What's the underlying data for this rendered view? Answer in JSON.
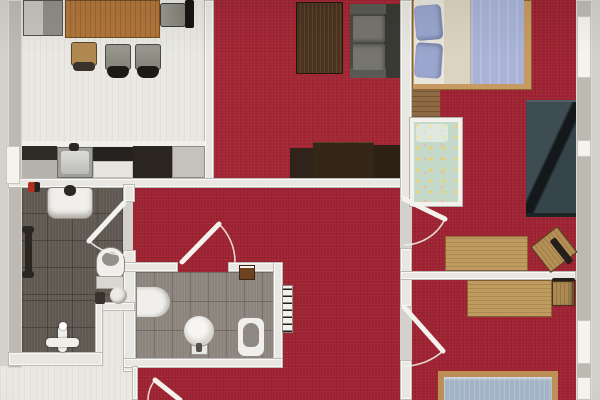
{
  "meta": {
    "kind": "rendered-apartment-floor-plan-photo",
    "text_labels_visible": "none"
  },
  "palette": {
    "paper": "#d3d1cb",
    "carpet": "#9e2130",
    "carpet_living": "#a32433",
    "floor_light": "#e9e8e2",
    "tile_dark": "#5f5952",
    "tile_mid": "#8b857d",
    "wall": "#bdbab2",
    "wall_inner": "#e9e7e1",
    "wood_table": "#b0763c",
    "wood_desk": "#bf9b60",
    "wood_bedframe": "#c79a62",
    "dark_sideboard": "#352718",
    "coffee_table": "#4a3420",
    "sofa_seat": "#75756d",
    "sofa_frame": "#4a4a44",
    "teal_sofa": "#3d4d52",
    "bed_blue": "#a9b3d6",
    "pillow_blue": "#9aa6cd",
    "bed3_blue": "#a3b4c6",
    "crib_green": "#c5d9cb",
    "fixture_white": "#f0efeb",
    "door_white": "#f4f2ec"
  },
  "plan": {
    "rooms": [
      {
        "id": "kitchen-dining",
        "floor": "light-wood-white",
        "furniture": [
          "sideboard-cabinet",
          "dining-table",
          "dining-chair-wood",
          "dining-chair-gray-1",
          "dining-chair-gray-2",
          "dining-chair-end",
          "kitchen-counter",
          "kitchen-sink",
          "cooktop",
          "tall-cabinet",
          "fridge-cabinet"
        ]
      },
      {
        "id": "living-room",
        "floor": "red-carpet",
        "furniture": [
          "coffee-table",
          "sofa",
          "tv-sideboard"
        ]
      },
      {
        "id": "bedroom",
        "floor": "red-carpet",
        "furniture": [
          "double-bed",
          "wood-floor-patch",
          "crib",
          "teal-sofa",
          "desk",
          "desk-chair"
        ]
      },
      {
        "id": "kids-room",
        "floor": "red-carpet",
        "furniture": [
          "desk",
          "desk-chair",
          "single-bed"
        ]
      },
      {
        "id": "bathroom",
        "floor": "dark-tile",
        "furniture": [
          "washbasin",
          "faucet",
          "towel-rail",
          "toilet",
          "cistern",
          "stool-round",
          "waste-bin",
          "shower-fitting",
          "red-knob"
        ]
      },
      {
        "id": "wc",
        "floor": "gray-tile",
        "furniture": [
          "washstand",
          "pedestal-basin",
          "toilet",
          "shelf-box",
          "radiator"
        ]
      },
      {
        "id": "hallway",
        "floor": "red-carpet",
        "furniture": []
      },
      {
        "id": "entry",
        "floor": "light-floor",
        "furniture": []
      }
    ],
    "doors": [
      "bathroom-door",
      "hallway-door",
      "bedroom-door",
      "kids-room-door",
      "entry-door"
    ],
    "windows": [
      "left-wall-window",
      "right-wall-window-top",
      "right-wall-window-mid",
      "right-wall-window-low",
      "right-wall-window-bottom"
    ]
  }
}
